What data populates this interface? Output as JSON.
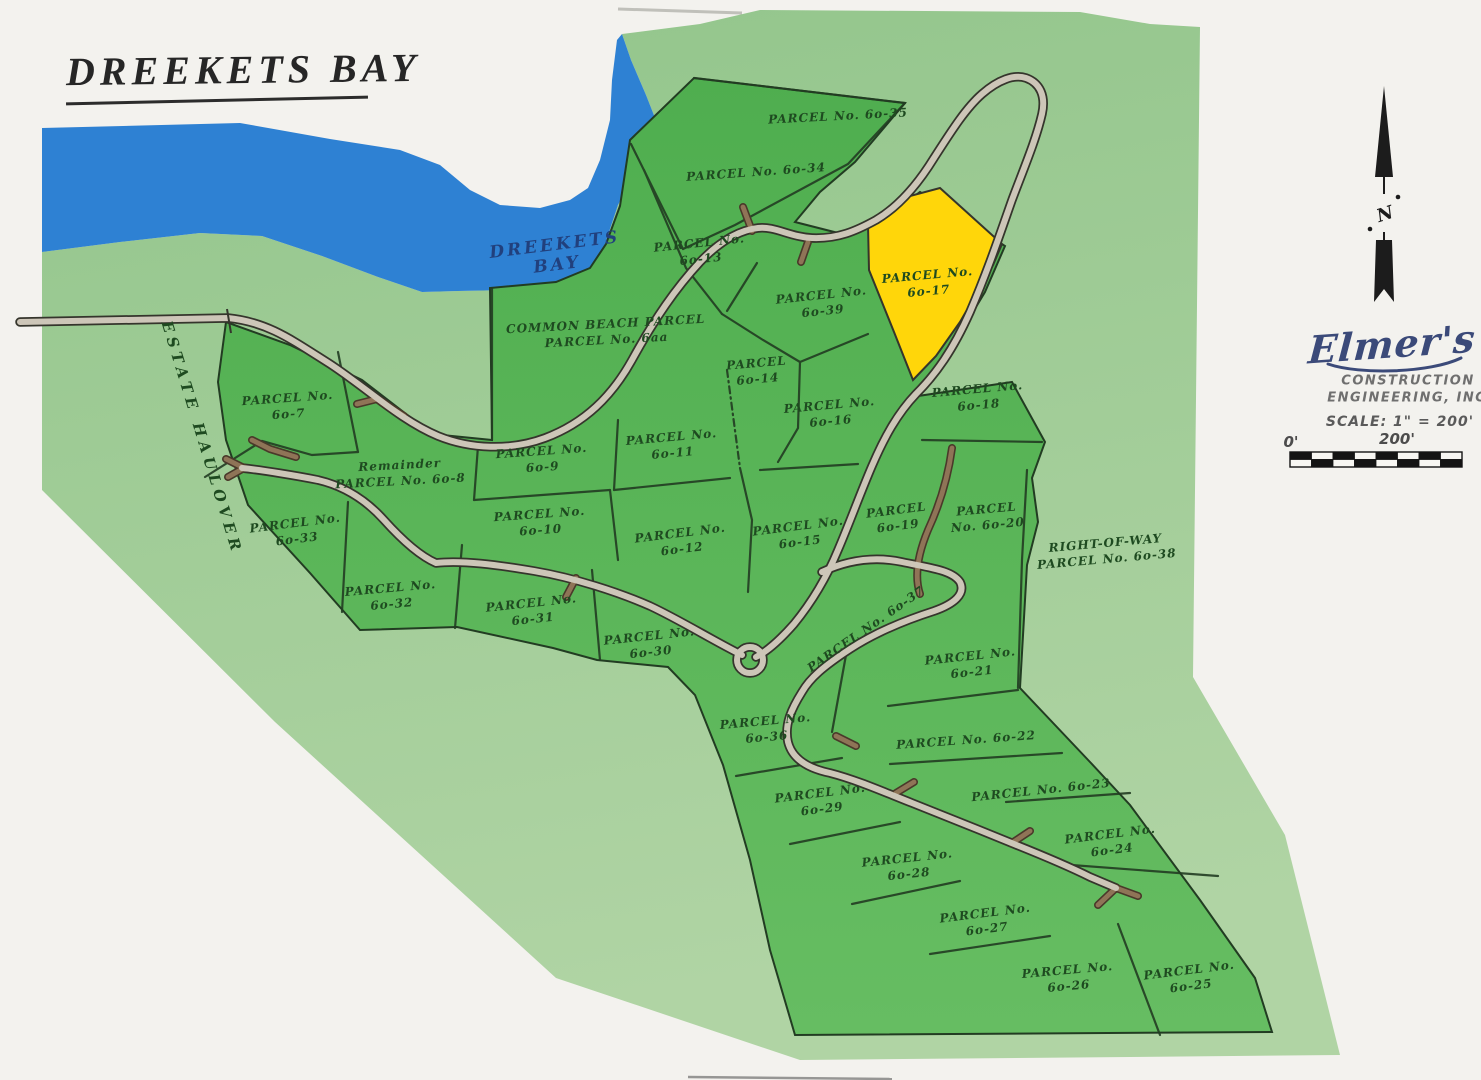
{
  "title": "DREEKETS BAY",
  "water": {
    "line1": "DREEKETS",
    "line2": "BAY"
  },
  "estate_label": "ESTATE HAULOVER",
  "north_label": "N",
  "highlighted_parcel": "6o-17",
  "parcels": [
    {
      "id": "6o-35",
      "lines": [
        "PARCEL No. 6o-35"
      ],
      "x": 838,
      "y": 116,
      "rot": -3
    },
    {
      "id": "6o-34",
      "lines": [
        "PARCEL No. 6o-34"
      ],
      "x": 756,
      "y": 172,
      "rot": -4
    },
    {
      "id": "6o-13",
      "lines": [
        "PARCEL No.",
        "6o-13"
      ],
      "x": 700,
      "y": 250,
      "rot": -6
    },
    {
      "id": "6o-17",
      "lines": [
        "PARCEL No.",
        "6o-17"
      ],
      "x": 928,
      "y": 282,
      "rot": -5,
      "highlight": true
    },
    {
      "id": "6o-39",
      "lines": [
        "PARCEL No.",
        "6o-39"
      ],
      "x": 822,
      "y": 302,
      "rot": -6
    },
    {
      "id": "6aa",
      "lines": [
        "COMMON BEACH PARCEL",
        "PARCEL No. 6aa"
      ],
      "x": 606,
      "y": 331,
      "rot": -3
    },
    {
      "id": "6o-14",
      "lines": [
        "PARCEL",
        "6o-14"
      ],
      "x": 757,
      "y": 370,
      "rot": -5
    },
    {
      "id": "6o-7",
      "lines": [
        "PARCEL No.",
        "6o-7"
      ],
      "x": 288,
      "y": 405,
      "rot": -4
    },
    {
      "id": "6o-16",
      "lines": [
        "PARCEL No.",
        "6o-16"
      ],
      "x": 830,
      "y": 412,
      "rot": -5
    },
    {
      "id": "6o-18",
      "lines": [
        "PARCEL No.",
        "6o-18"
      ],
      "x": 978,
      "y": 396,
      "rot": -5
    },
    {
      "id": "6o-11",
      "lines": [
        "PARCEL No.",
        "6o-11"
      ],
      "x": 672,
      "y": 444,
      "rot": -5
    },
    {
      "id": "6o-9",
      "lines": [
        "PARCEL No.",
        "6o-9"
      ],
      "x": 542,
      "y": 458,
      "rot": -4
    },
    {
      "id": "6o-8",
      "lines": [
        "Remainder",
        "PARCEL No. 6o-8"
      ],
      "x": 400,
      "y": 472,
      "rot": -3
    },
    {
      "id": "6o-10",
      "lines": [
        "PARCEL No.",
        "6o-10"
      ],
      "x": 540,
      "y": 521,
      "rot": -4
    },
    {
      "id": "6o-33",
      "lines": [
        "PARCEL No.",
        "6o-33"
      ],
      "x": 296,
      "y": 530,
      "rot": -7
    },
    {
      "id": "6o-12",
      "lines": [
        "PARCEL No.",
        "6o-12"
      ],
      "x": 681,
      "y": 540,
      "rot": -7
    },
    {
      "id": "6o-15",
      "lines": [
        "PARCEL No.",
        "6o-15"
      ],
      "x": 799,
      "y": 533,
      "rot": -7
    },
    {
      "id": "6o-19",
      "lines": [
        "PARCEL",
        "6o-19"
      ],
      "x": 897,
      "y": 517,
      "rot": -7
    },
    {
      "id": "6o-20",
      "lines": [
        "PARCEL",
        "No. 6o-20"
      ],
      "x": 987,
      "y": 516,
      "rot": -5
    },
    {
      "id": "6o-38",
      "lines": [
        "RIGHT-OF-WAY",
        "PARCEL No. 6o-38"
      ],
      "x": 1106,
      "y": 550,
      "rot": -5
    },
    {
      "id": "6o-32",
      "lines": [
        "PARCEL No.",
        "6o-32"
      ],
      "x": 391,
      "y": 595,
      "rot": -5
    },
    {
      "id": "6o-31",
      "lines": [
        "PARCEL No.",
        "6o-31"
      ],
      "x": 532,
      "y": 610,
      "rot": -6
    },
    {
      "id": "6o-30",
      "lines": [
        "PARCEL No.",
        "6o-30"
      ],
      "x": 650,
      "y": 643,
      "rot": -6
    },
    {
      "id": "6o-37",
      "lines": [
        "PARCEL No. 6o-37"
      ],
      "x": 866,
      "y": 629,
      "rot": -35
    },
    {
      "id": "6o-21",
      "lines": [
        "PARCEL No.",
        "6o-21"
      ],
      "x": 971,
      "y": 663,
      "rot": -6
    },
    {
      "id": "6o-36",
      "lines": [
        "PARCEL No.",
        "6o-36"
      ],
      "x": 766,
      "y": 728,
      "rot": -5
    },
    {
      "id": "6o-22",
      "lines": [
        "PARCEL No. 6o-22"
      ],
      "x": 966,
      "y": 740,
      "rot": -4
    },
    {
      "id": "6o-29",
      "lines": [
        "PARCEL No.",
        "6o-29"
      ],
      "x": 821,
      "y": 800,
      "rot": -7
    },
    {
      "id": "6o-23",
      "lines": [
        "PARCEL No. 6o-23"
      ],
      "x": 1041,
      "y": 790,
      "rot": -6
    },
    {
      "id": "6o-24",
      "lines": [
        "PARCEL No.",
        "6o-24"
      ],
      "x": 1111,
      "y": 841,
      "rot": -7
    },
    {
      "id": "6o-28",
      "lines": [
        "PARCEL No.",
        "6o-28"
      ],
      "x": 908,
      "y": 865,
      "rot": -6
    },
    {
      "id": "6o-27",
      "lines": [
        "PARCEL No.",
        "6o-27"
      ],
      "x": 986,
      "y": 920,
      "rot": -7
    },
    {
      "id": "6o-26",
      "lines": [
        "PARCEL No.",
        "6o-26"
      ],
      "x": 1068,
      "y": 977,
      "rot": -5
    },
    {
      "id": "6o-25",
      "lines": [
        "PARCEL No.",
        "6o-25"
      ],
      "x": 1190,
      "y": 977,
      "rot": -7
    }
  ],
  "legend": {
    "brand": "Elmer's",
    "line1": "CONSTRUCTION",
    "line2": "ENGINEERING, INC.",
    "scale": "SCALE: 1\" = 200'",
    "bar_left": "0'",
    "bar_right": "200'"
  },
  "colors": {
    "paper": "#f3f2ee",
    "water": "#2e81d3",
    "land_outer_top": "#92c58b",
    "land_outer_bottom": "#b0d4a4",
    "parcel_green_top": "#4fae4f",
    "parcel_green_bottom": "#66bd62",
    "highlight_yellow": "#ffd60a",
    "road_fill": "#cdc6b8",
    "dirt_road": "#8f7457",
    "boundary": "#223c22",
    "label_green": "#1e4a20",
    "navy": "#21407d"
  }
}
